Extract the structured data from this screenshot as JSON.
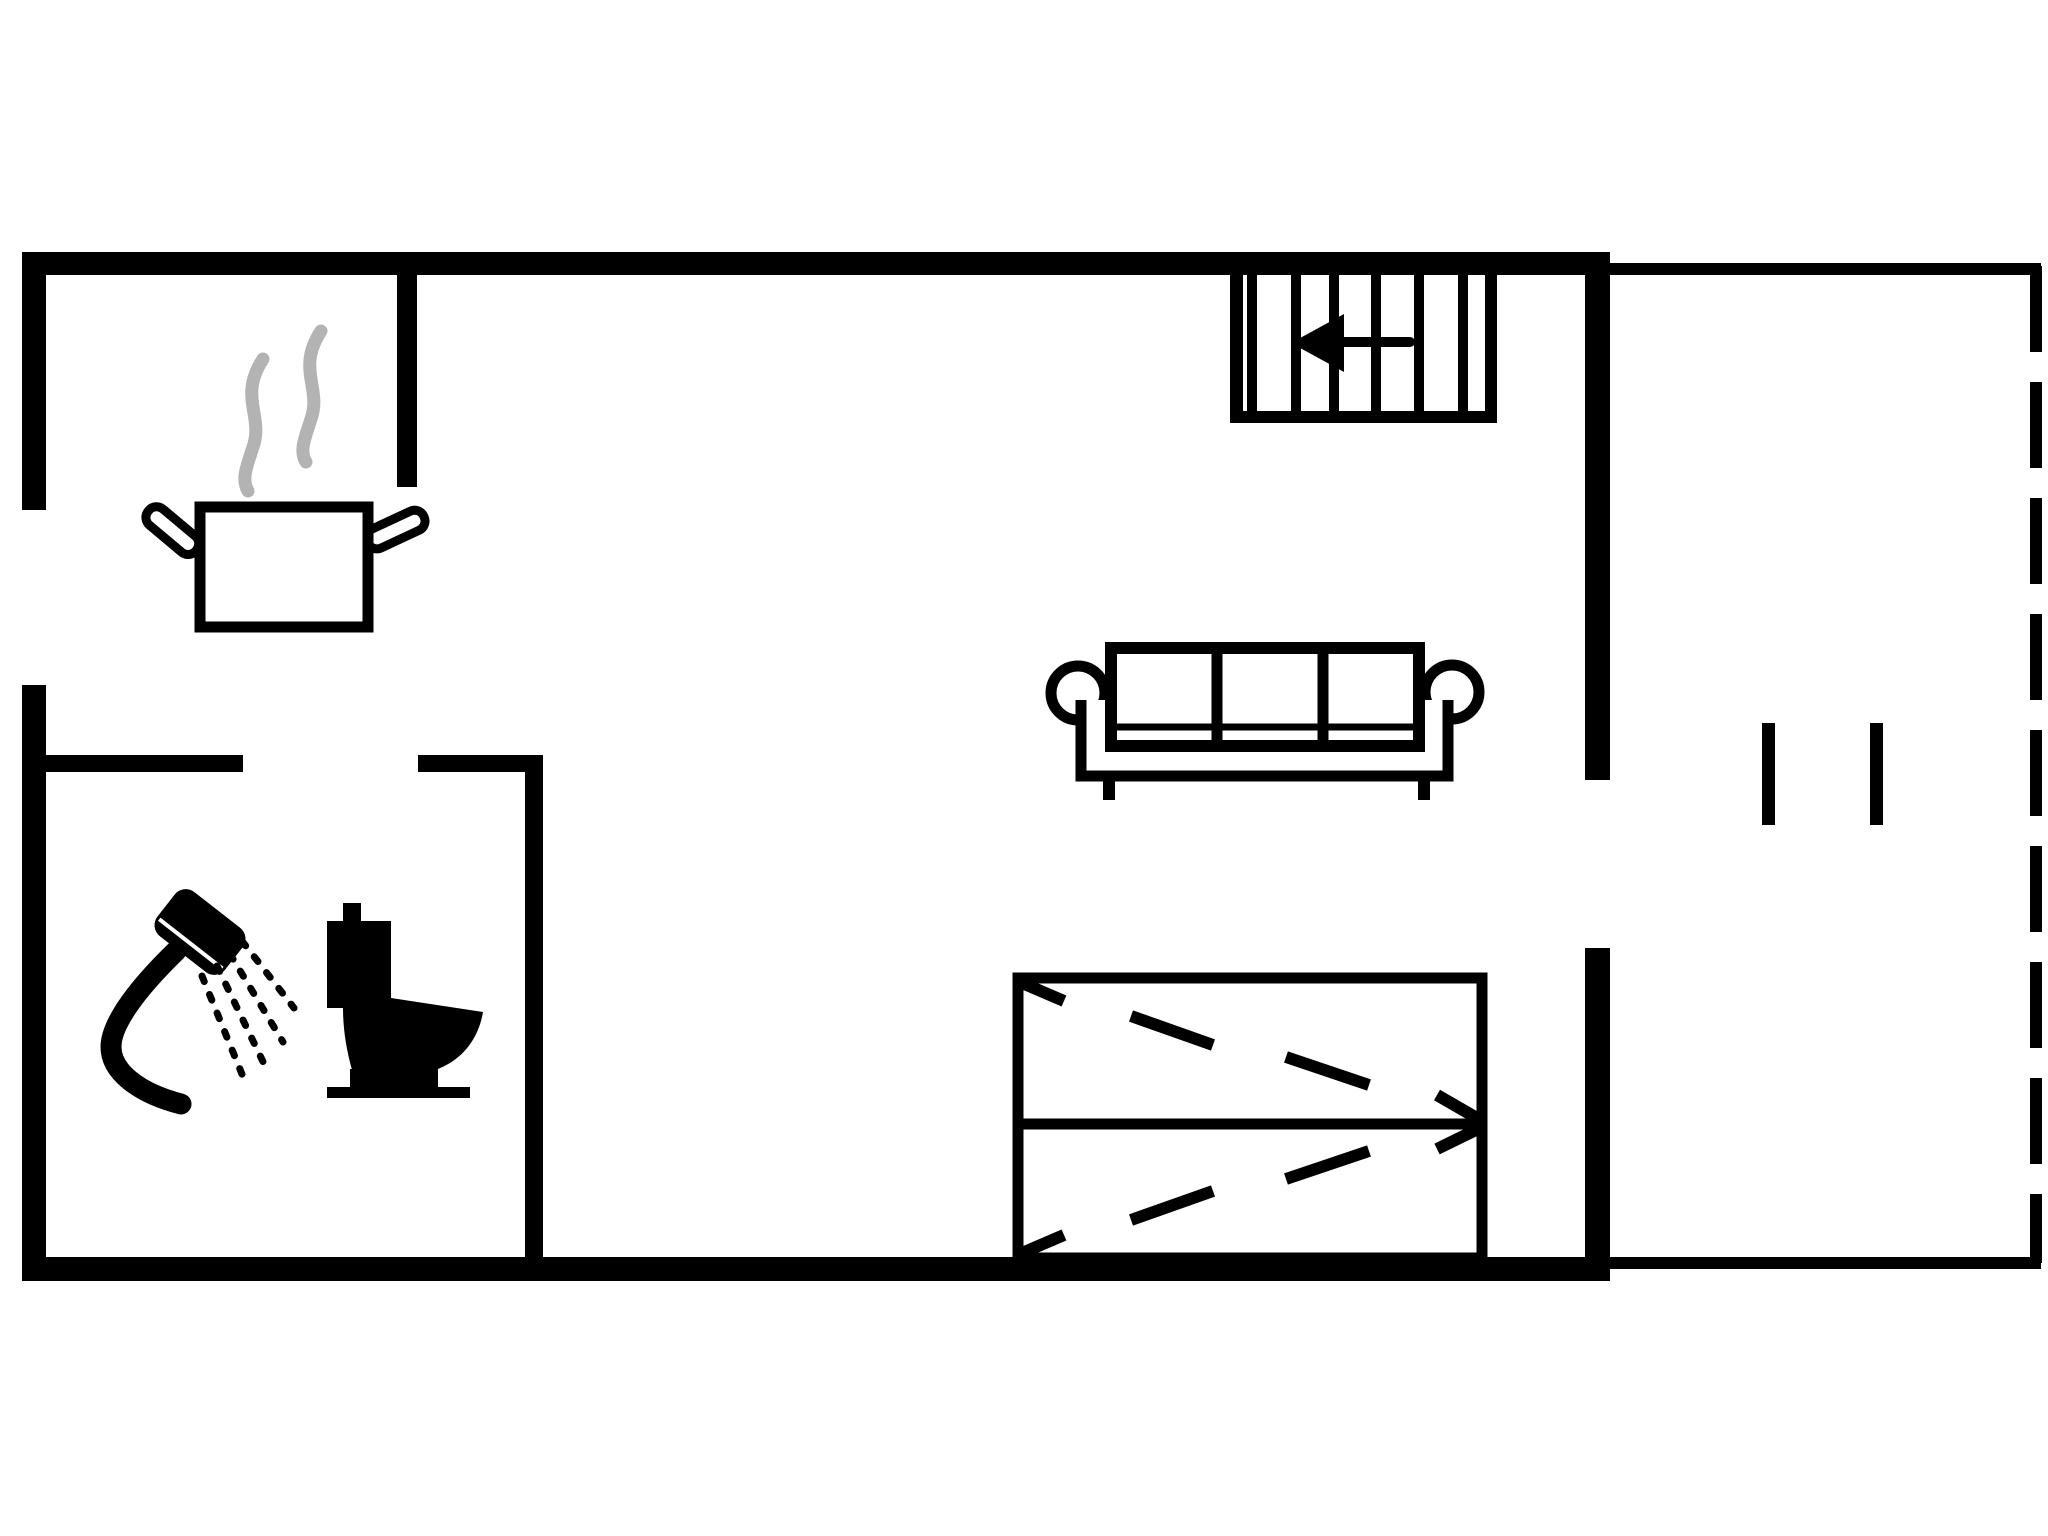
{
  "canvas": {
    "width": 2048,
    "height": 1536
  },
  "colors": {
    "ink": "#000000",
    "paper": "#ffffff",
    "steam": "#b3b3b3"
  },
  "legend": {
    "icons": [
      {
        "name": "cooking-pot-icon",
        "depicts": "steaming cooking pot marking the kitchen corner"
      },
      {
        "name": "steam-icon",
        "depicts": "two grey steam wisps above the pot"
      },
      {
        "name": "shower-icon",
        "depicts": "hand shower with water spray marking the bathroom"
      },
      {
        "name": "toilet-icon",
        "depicts": "toilet marking the bathroom"
      },
      {
        "name": "sofa-icon",
        "depicts": "three-seat sofa in the living area"
      },
      {
        "name": "bunk-bed-icon",
        "depicts": "bed symbol with two sleeping places and dashed direction arrows"
      },
      {
        "name": "staircase-icon",
        "depicts": "staircase with six treads at the top right"
      },
      {
        "name": "stairs-arrow-icon",
        "depicts": "arrow showing the stair walking direction (pointing left)"
      },
      {
        "name": "terrace-door-marks",
        "depicts": "two short opening marks on the terrace"
      },
      {
        "name": "terrace-dashed-edge",
        "depicts": "dashed open edge of the terrace"
      }
    ]
  }
}
